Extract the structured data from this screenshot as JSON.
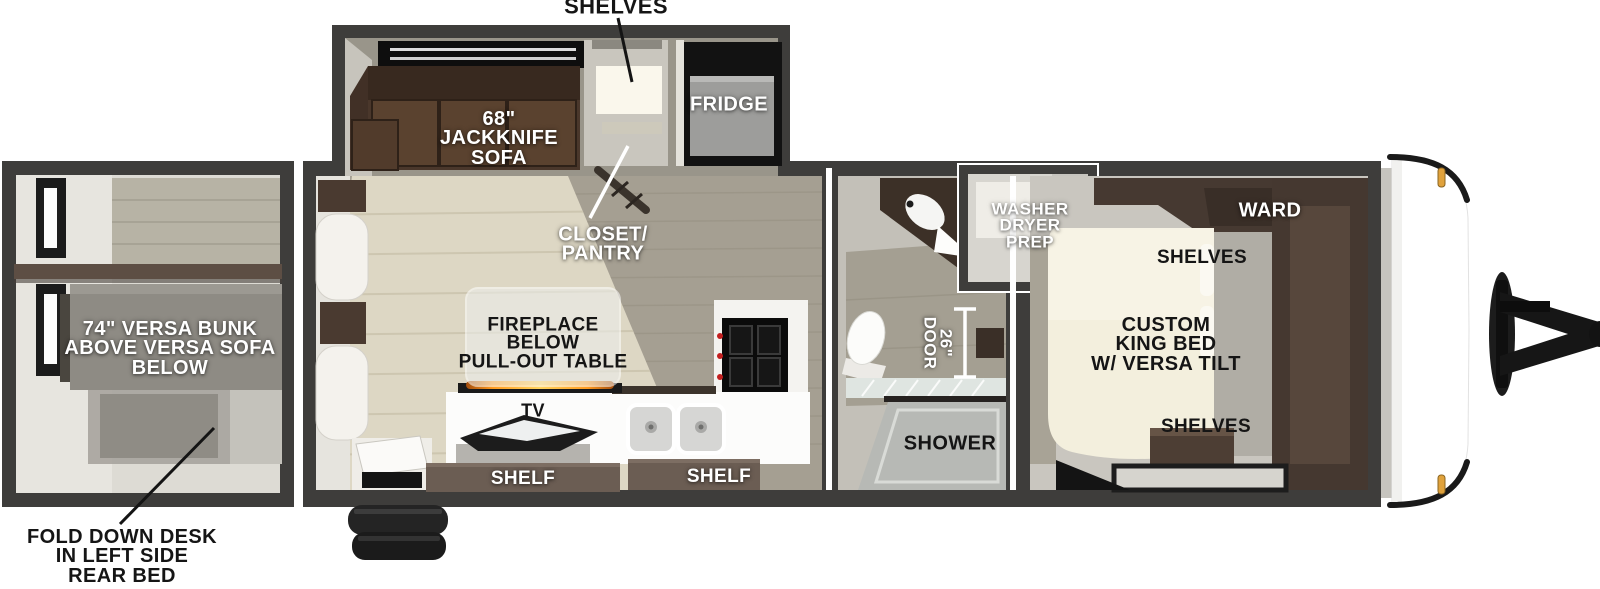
{
  "title": "Travel trailer floor plan",
  "colors": {
    "wall": "#3e3d3b",
    "floor_light": "#ddd7c4",
    "floor_olive": "#a59f92",
    "lining": "#c9c6bf",
    "cabinet_brown": "#463931",
    "sofa_brown": "#4a372b",
    "flame_accent": "#ff9a1f",
    "marker_light": "#e0a23c",
    "label_white": "#ffffff",
    "label_black": "#141414"
  },
  "labels": {
    "shelves_top": "SHELVES",
    "jackknife_sofa": [
      "68\"",
      "JACKKNIFE",
      "SOFA"
    ],
    "fridge": "FRIDGE",
    "closet_pantry": [
      "CLOSET/",
      "PANTRY"
    ],
    "washer_dryer_prep": [
      "WASHER",
      "DRYER",
      "PREP"
    ],
    "ward": "WARD",
    "shelves_bed_head": "SHELVES",
    "custom_king_bed": [
      "CUSTOM",
      "KING BED",
      "W/ VERSA TILT"
    ],
    "shelves_bed_foot": "SHELVES",
    "versa_bunk": [
      "74\" VERSA BUNK",
      "ABOVE VERSA SOFA",
      "BELOW"
    ],
    "fireplace": [
      "FIREPLACE",
      "BELOW",
      "PULL-OUT TABLE"
    ],
    "tv": "TV",
    "shelf_left": "SHELF",
    "shelf_right": "SHELF",
    "door_26": [
      "26\"",
      "DOOR"
    ],
    "shower": "SHOWER",
    "fold_down_desk": [
      "FOLD DOWN DESK",
      "IN LEFT SIDE",
      "REAR BED"
    ]
  }
}
